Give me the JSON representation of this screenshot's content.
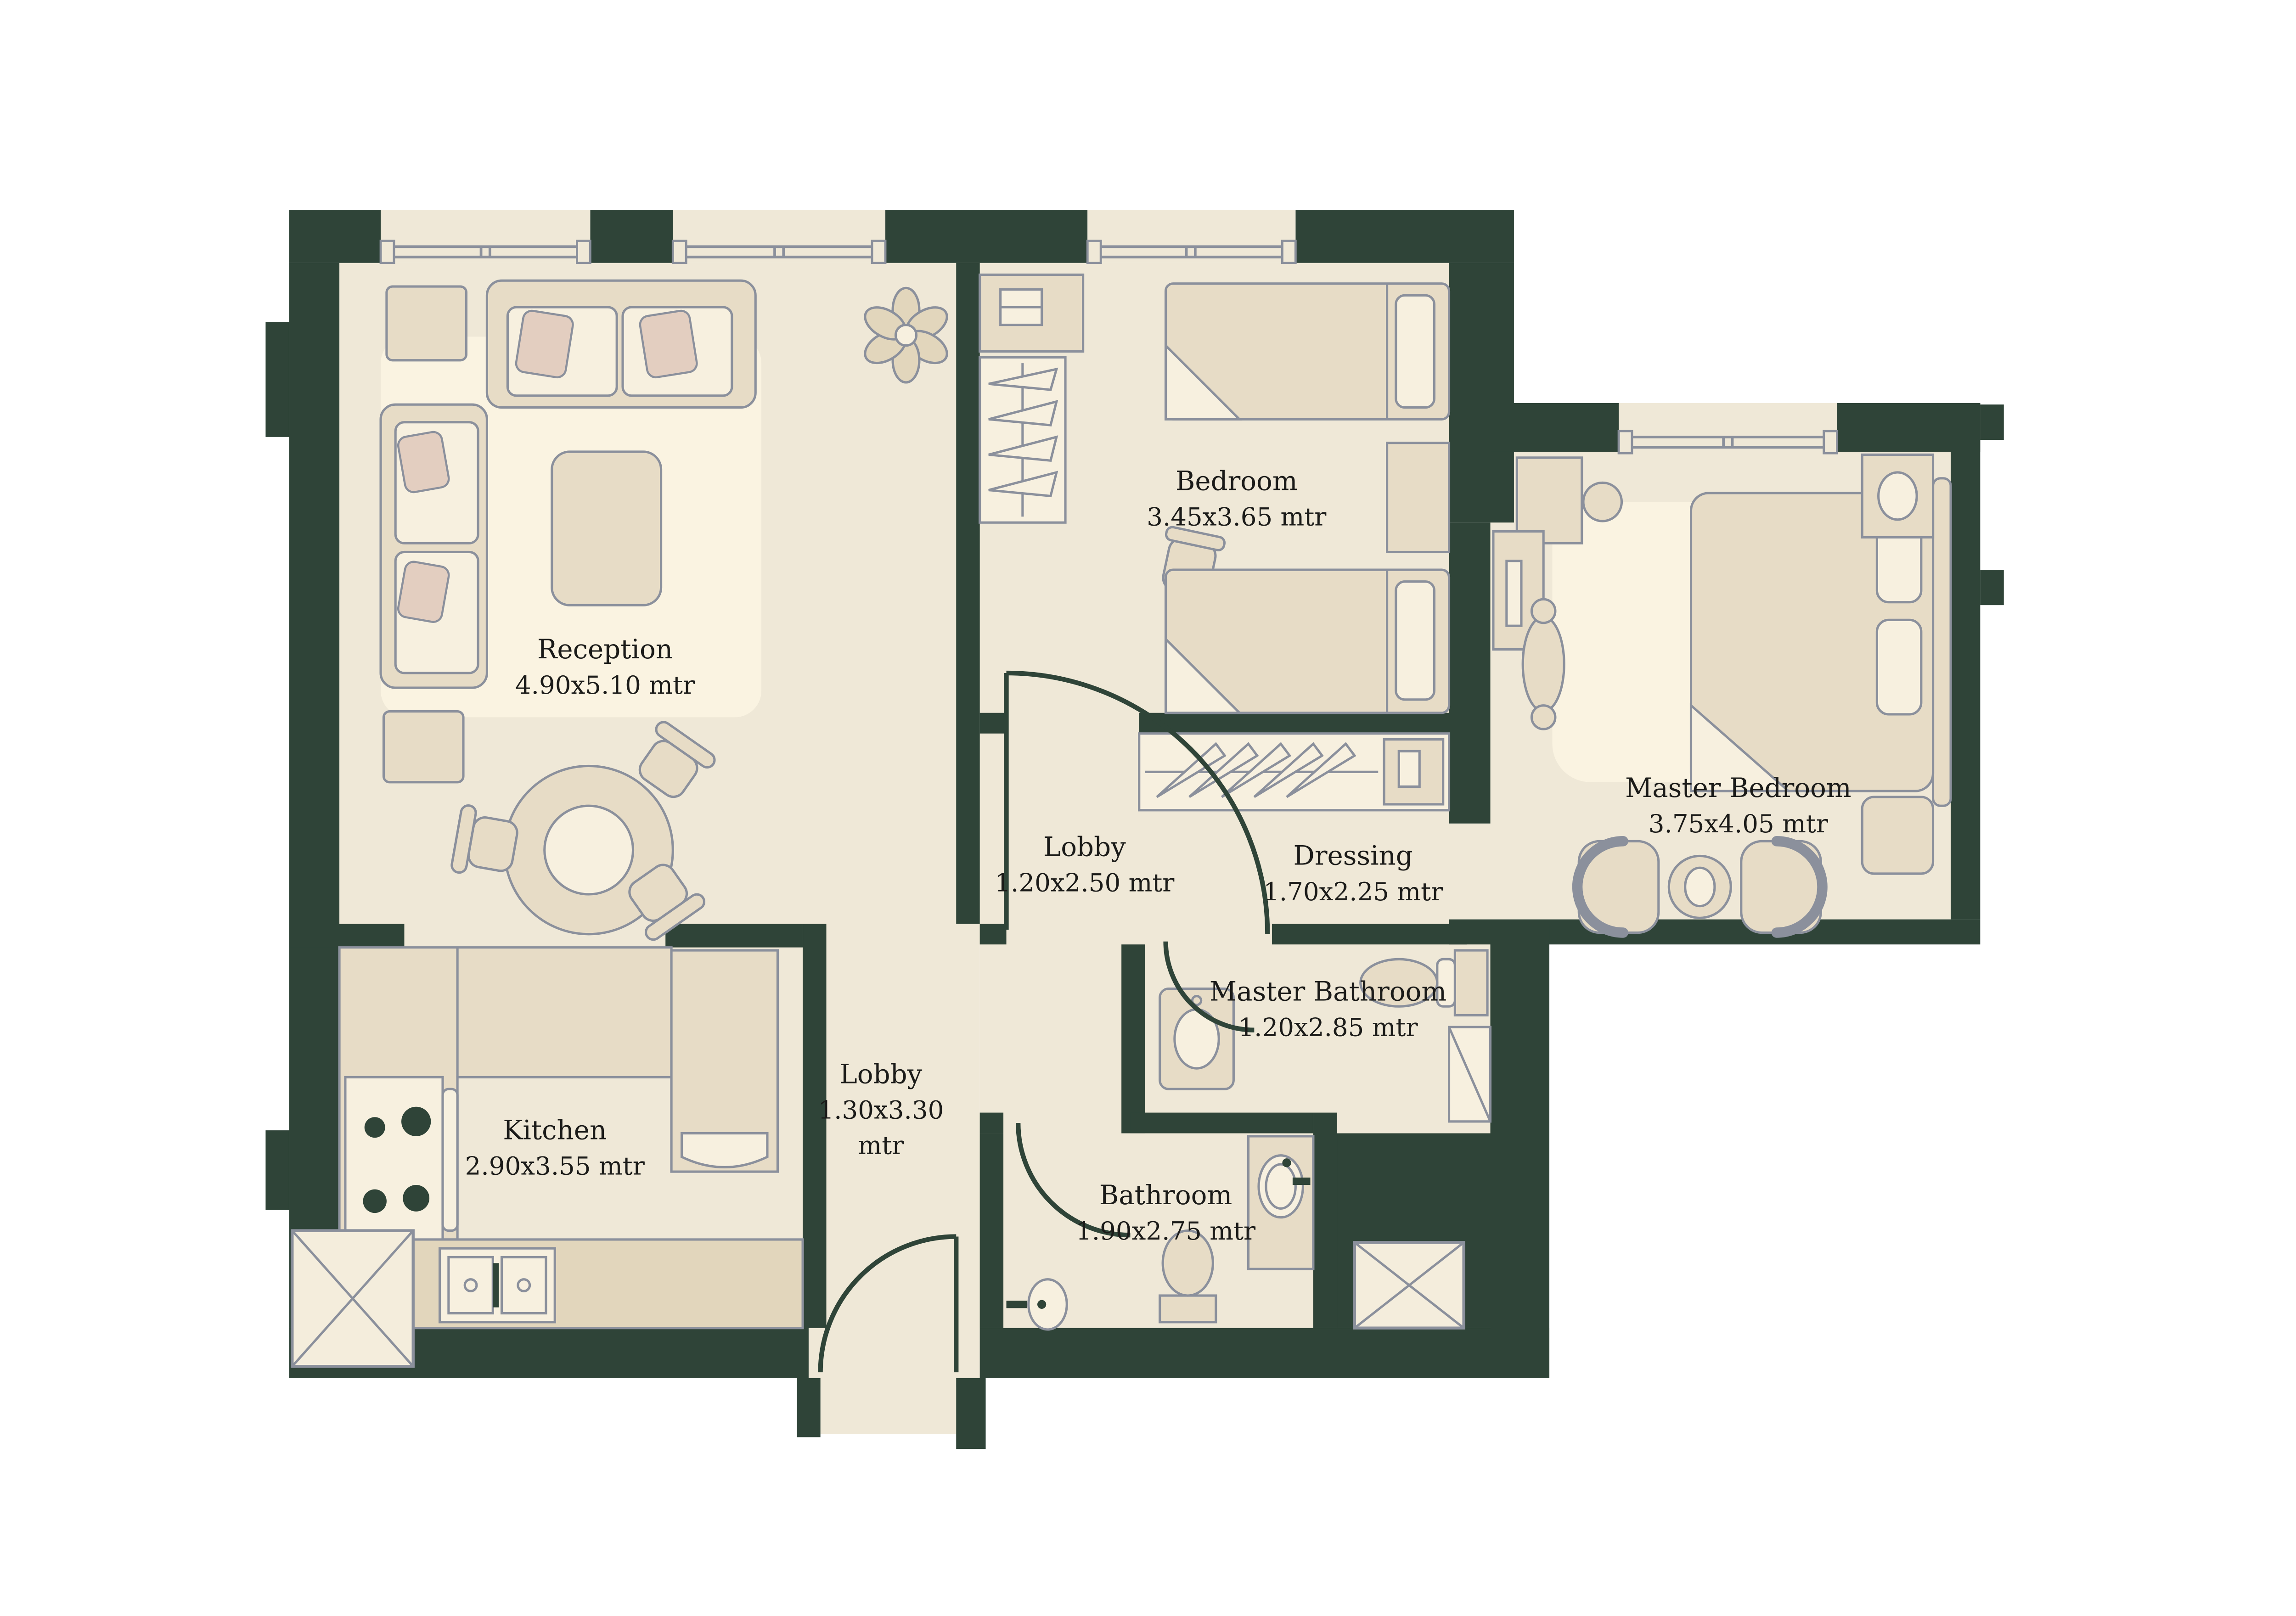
{
  "plan": {
    "type": "apartment-floor-plan",
    "unit_suffix": "mtr",
    "colors": {
      "background": "#FFFFFF",
      "wall": "#2F4438",
      "floor": "#EFE8D7",
      "floor_highlight": "#FAF3E1",
      "furniture": "#E7DCC6",
      "furniture_light": "#F7F0DF",
      "cushion_accent": "#E3CEC0",
      "outline": "#8B909C",
      "label_text": "#1B1B19"
    },
    "rooms": {
      "reception": {
        "name": "Reception",
        "dims": "4.90x5.10 mtr"
      },
      "bedroom": {
        "name": "Bedroom",
        "dims": "3.45x3.65 mtr"
      },
      "master_bedroom": {
        "name": "Master Bedroom",
        "dims": "3.75x4.05 mtr"
      },
      "lobby_upper": {
        "name": "Lobby",
        "dims": "1.20x2.50 mtr"
      },
      "dressing": {
        "name": "Dressing",
        "dims": "1.70x2.25 mtr"
      },
      "master_bathroom": {
        "name": "Master Bathroom",
        "dims": "1.20x2.85 mtr"
      },
      "lobby_lower": {
        "name": "Lobby",
        "dims_line1": "1.30x3.30",
        "dims_line2": "mtr"
      },
      "kitchen": {
        "name": "Kitchen",
        "dims": "2.90x3.55 mtr"
      },
      "bathroom": {
        "name": "Bathroom",
        "dims": "1.90x2.75 mtr"
      }
    }
  }
}
